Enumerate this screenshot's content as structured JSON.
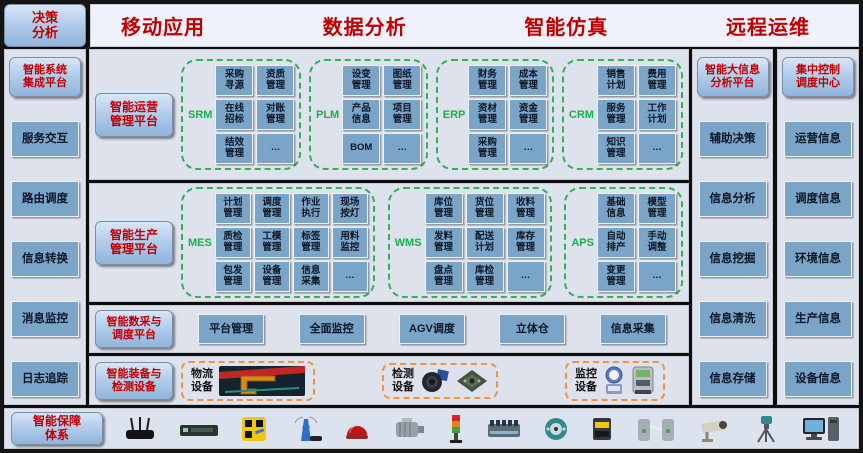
{
  "colors": {
    "accent_red": "#c00000",
    "chip_blue": "#7ba4c9",
    "group_green": "#2db457",
    "device_orange": "#f5923e",
    "panel_bg": "#dde2ec",
    "button_blue_top": "#d7e6f7",
    "button_blue_bottom": "#8fb4dc"
  },
  "top": {
    "decision_button": "决策\n分析",
    "headers": [
      "移动应用",
      "数据分析",
      "智能仿真",
      "远程运维"
    ]
  },
  "sidebar": {
    "title": "智能系统\n集成平台",
    "items": [
      "服务交互",
      "路由调度",
      "信息转换",
      "消息监控",
      "日志追踪"
    ]
  },
  "main": {
    "p1": {
      "label": "智能运营\n管理平台",
      "groups": [
        {
          "name": "SRM",
          "modules": [
            "采购\n寻源",
            "资质\n管理",
            "在线\n招标",
            "对账\n管理",
            "结效\n管理",
            "…"
          ]
        },
        {
          "name": "PLM",
          "modules": [
            "设变\n管理",
            "图纸\n管理",
            "产品\n信息",
            "项目\n管理",
            "BOM",
            "…"
          ]
        },
        {
          "name": "ERP",
          "modules": [
            "财务\n管理",
            "成本\n管理",
            "资材\n管理",
            "资金\n管理",
            "采购\n管理",
            "…"
          ]
        },
        {
          "name": "CRM",
          "modules": [
            "销售\n计划",
            "费用\n管理",
            "服务\n管理",
            "工作\n计划",
            "知识\n管理",
            "…"
          ]
        }
      ]
    },
    "p2": {
      "label": "智能生产\n管理平台",
      "groups": [
        {
          "name": "MES",
          "modules": [
            "计划\n管理",
            "调度\n管理",
            "作业\n执行",
            "现场\n按灯",
            "质检\n管理",
            "工模\n管理",
            "标签\n管理",
            "用料\n监控",
            "包发\n管理",
            "设备\n管理",
            "信息\n采集",
            "…"
          ]
        },
        {
          "name": "WMS",
          "modules": [
            "库位\n管理",
            "货位\n管理",
            "收料\n管理",
            "发料\n管理",
            "配送\n计划",
            "库存\n管理",
            "盘点\n管理",
            "库检\n管理",
            "…"
          ]
        },
        {
          "name": "APS",
          "modules": [
            "基础\n信息",
            "模型\n管理",
            "自动\n排产",
            "手动\n调整",
            "变更\n管理",
            "…"
          ]
        }
      ]
    },
    "p3": {
      "label": "智能数采与\n调度平台",
      "items": [
        "平台管理",
        "全面监控",
        "AGV调度",
        "立体仓",
        "信息采集"
      ]
    },
    "p4": {
      "label": "智能装备与\n检测设备",
      "boxes": [
        {
          "label": "物流\n设备",
          "icons": [
            "crane-image"
          ]
        },
        {
          "label": "检测\n设备",
          "icons": [
            "camera-lens-image",
            "circuit-board-image"
          ]
        },
        {
          "label": "监控\n设备",
          "icons": [
            "water-meter-image",
            "power-meter-image"
          ]
        }
      ]
    }
  },
  "col1": {
    "title": "智能大信息\n分析平台",
    "items": [
      "辅助决策",
      "信息分析",
      "信息挖掘",
      "信息清洗",
      "信息存储"
    ]
  },
  "col2": {
    "title": "集中控制\n调度中心",
    "items": [
      "运营信息",
      "调度信息",
      "环境信息",
      "生产信息",
      "设备信息"
    ]
  },
  "bottom": {
    "label": "智能保障\n体系",
    "device_icons": [
      "wireless-router",
      "network-switch",
      "qr-code-scanner",
      "antenna-tower",
      "alarm-dome-light",
      "electric-motor",
      "signal-tower-light",
      "plc-terminal-module",
      "rotary-encoder",
      "barcode-reader",
      "turnstile-gate",
      "cctv-camera",
      "surveying-instrument",
      "desktop-computer"
    ]
  }
}
